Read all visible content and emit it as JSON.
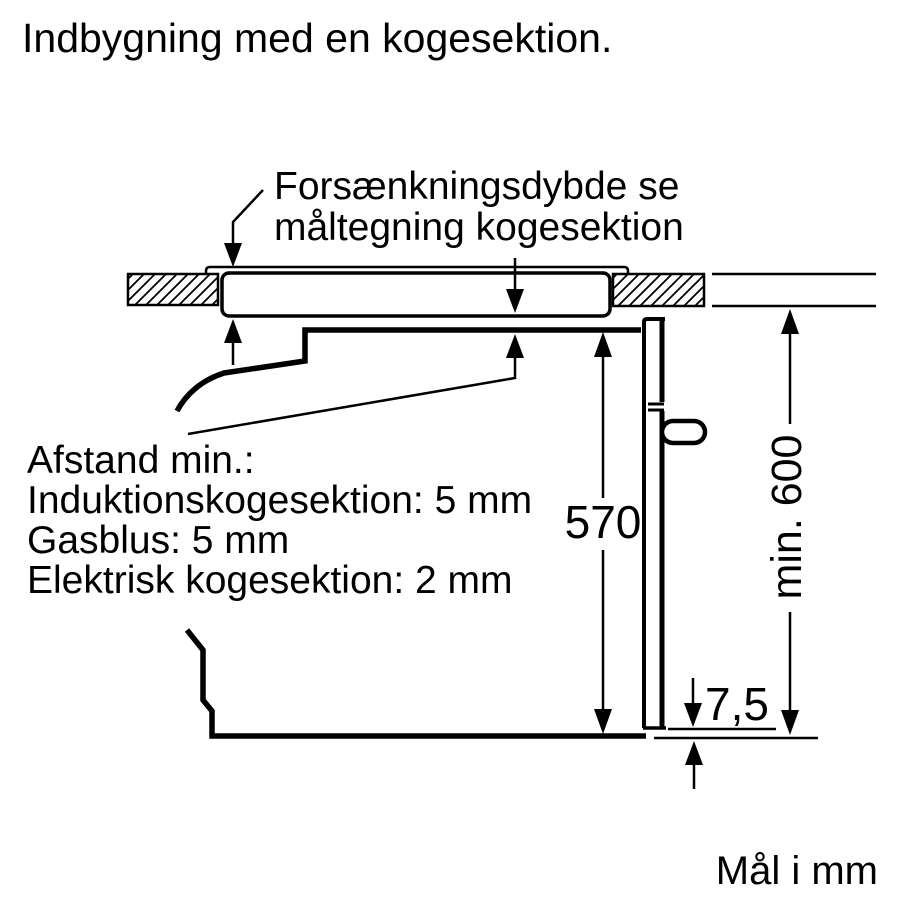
{
  "colors": {
    "ink": "#000000",
    "paper": "#ffffff"
  },
  "title": "Indbygning med en kogesektion.",
  "callouts": {
    "recess_note": {
      "line1": "Forsænkningsdybde se",
      "line2": "måltegning kogesektion"
    },
    "clearance_note": {
      "heading": "Afstand min.:",
      "item1": "Induktionskogesektion: 5 mm",
      "item2": "Gasblus: 5 mm",
      "item3": "Elektrisk kogesektion: 2 mm"
    }
  },
  "dimensions": {
    "oven_front_height": "570",
    "min_niche_height": "min. 600",
    "bottom_clearance": "7,5"
  },
  "units_note": "Mål i mm"
}
